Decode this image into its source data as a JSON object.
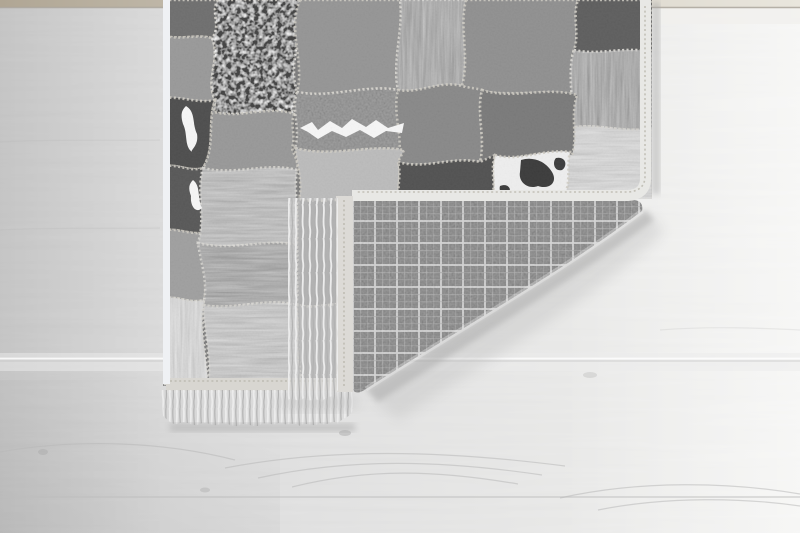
{
  "photo": {
    "subject": "patchwork hide rug with folded-back corner",
    "backing": "dark plaid woven fabric",
    "edge_finish": "white fringe tassels and pale binding",
    "setting": "light gray wood plank floor"
  },
  "floor": {
    "base_left": "#d2d2d2",
    "base_mid": "#dfdfdf",
    "base_right": "#f0f0ee",
    "top_strip_tan": "#b0a694",
    "top_strip_fade": "#e9e6dd",
    "seam": "#aaa49a",
    "seam_light": "#ffffff",
    "seam_gray": "#bdbdbd",
    "grain": "#b9b9b9",
    "knot": "#ababab",
    "shadow": "#a8a8a8"
  },
  "rug": {
    "base": "#6f6f6f",
    "stitch": "#c9c6bc",
    "spot_white": "#f3f3f3",
    "cow_dark": "#262626",
    "left_strip": "#eff1f4",
    "binding": {
      "edge": "#e8e8e5",
      "edge_stitch": "#b8b5ab",
      "bottom": "#d8d6d1",
      "flap_left": "#dcdad6",
      "loops": "#f4f4f2"
    },
    "plaid": {
      "base": "#474747",
      "line_bright": "#c6c6c6",
      "line_faint": "#8f8f8f",
      "fold_highlight": "#ededed"
    },
    "fringe": {
      "light": "#ececec",
      "dark": "#b2b2b2",
      "underlay": "#d6d6d6"
    },
    "patches": [
      {
        "name": "edge-top-dark",
        "color": "#5f5f5f"
      },
      {
        "name": "left-upper-gray",
        "color": "#8e8e8e"
      },
      {
        "name": "granite-black-speckled",
        "color": "#2d2d2d"
      },
      {
        "name": "top-gray",
        "color": "#898989"
      },
      {
        "name": "top-dark-shag",
        "color": "#3a3a3a"
      },
      {
        "name": "top-wide-gray",
        "color": "#838383"
      },
      {
        "name": "top-right-dark",
        "color": "#4d4d4d"
      },
      {
        "name": "right-dark-shag",
        "color": "#343434"
      },
      {
        "name": "corner-light-fur",
        "color": "#c3c3c3"
      },
      {
        "name": "left-cowhide-dark",
        "color": "#3b3b3b"
      },
      {
        "name": "left-dark",
        "color": "#464646"
      },
      {
        "name": "mid-gray-band",
        "color": "#8d8d8d"
      },
      {
        "name": "white-streak-dark",
        "color": "#313131"
      },
      {
        "name": "center-gray",
        "color": "#7b7b7b"
      },
      {
        "name": "mid-right-gray",
        "color": "#6c6c6c"
      },
      {
        "name": "left-mid-gray",
        "color": "#949494"
      },
      {
        "name": "mid-fur-gray",
        "color": "#858585"
      },
      {
        "name": "light-gray-mid",
        "color": "#b3b3b3"
      },
      {
        "name": "cowhide-white",
        "color": "#ebebeb"
      },
      {
        "name": "bottom-mid-dark",
        "color": "#3f3f3f"
      },
      {
        "name": "dark-shag-lower",
        "color": "#333333"
      },
      {
        "name": "bottom-fluffy-gray",
        "color": "#a2a2a2"
      },
      {
        "name": "bottom-left-light-fur",
        "color": "#c6c6c6"
      },
      {
        "name": "under-fringe-gray",
        "color": "#757575"
      },
      {
        "name": "under-fringe-light",
        "color": "#8f8f8f"
      }
    ]
  }
}
